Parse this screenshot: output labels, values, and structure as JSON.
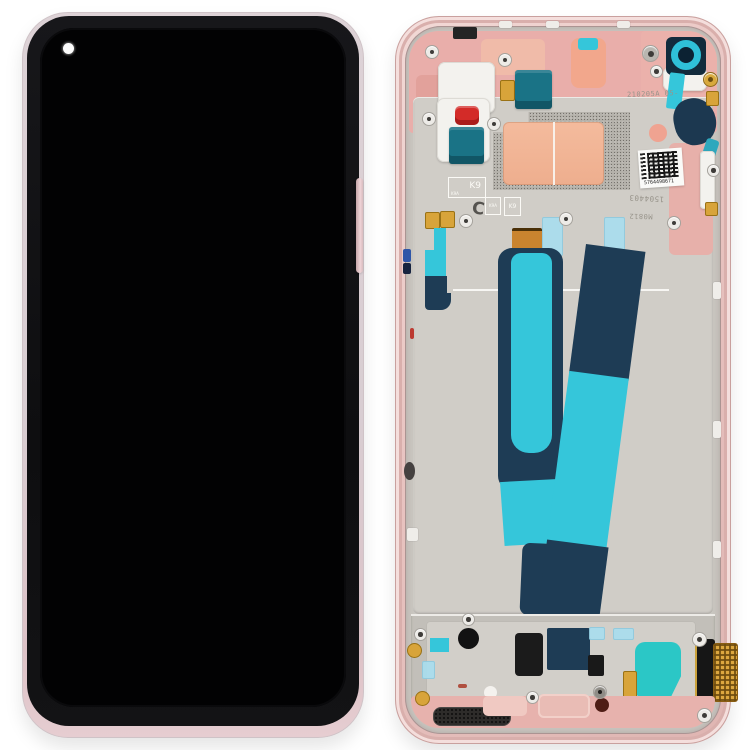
{
  "page": {
    "background": "#ffffff"
  },
  "markings": {
    "serial_etched": "210205A 05-",
    "code_etched": "1504403",
    "date_code": "M0812",
    "k9_box": {
      "sub": "K9A",
      "main": "K9"
    },
    "k9a_small": "K9A",
    "k9_small": "K9",
    "c_mark": "C",
    "sticker_number": "5764498671"
  },
  "colors": {
    "background": "#ffffff",
    "frame_pink": "#e8c3c0",
    "plastic_pink": "#e9aeaa",
    "plate_silver": "#d0cdc7",
    "flex_navy": "#1e3c55",
    "flex_teal": "#35c6da",
    "tape_blue": "#a9ddee",
    "copper_pad": "#f1b295",
    "component_red": "#d32b28",
    "component_teal": "#1a7386",
    "gold": "#d8a43a",
    "bright_teal": "#2bc7c6",
    "camera_ring_teal": "#2fc0d8",
    "screen_black": "#020203"
  }
}
